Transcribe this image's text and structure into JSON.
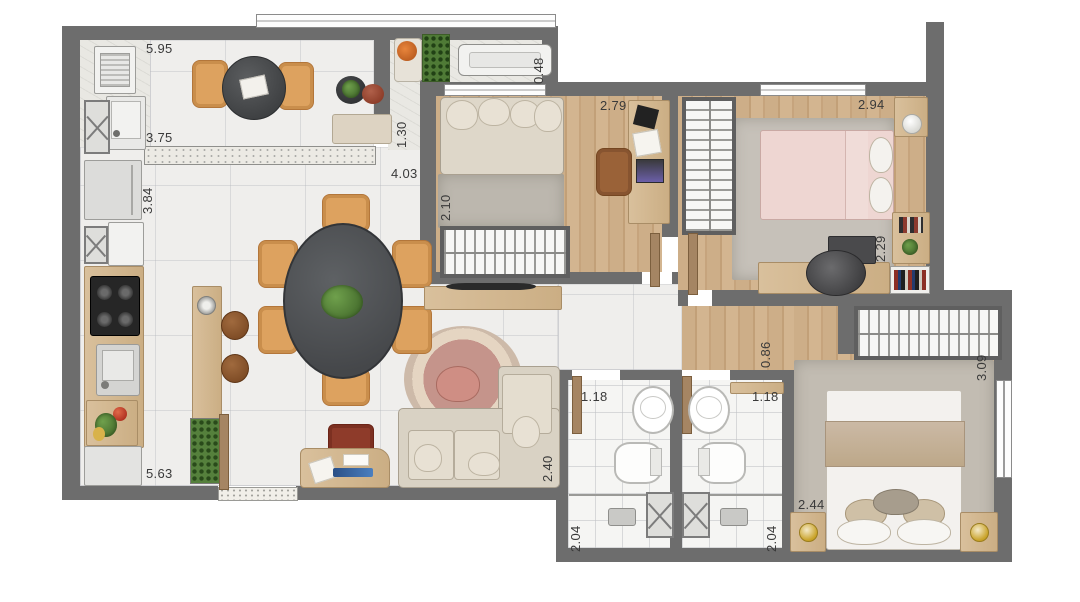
{
  "plan": {
    "type": "apartment-floor-plan",
    "colors": {
      "wall": "#6d6d6d",
      "marble_floor": "#efeeec",
      "wood_floor": "#cdae88",
      "bath_tile": "#f5f5f3",
      "dining_table": "#4c4e50",
      "chair_tan": "#dda25f",
      "sofa": "#d9d2c4",
      "bed_pink": "#eed6d2",
      "plant": "#55803c"
    },
    "dimension_labels": [
      {
        "id": "service-area-width",
        "text": "5.95",
        "orientation": "horizontal"
      },
      {
        "id": "kitchen-width",
        "text": "3.75",
        "orientation": "horizontal"
      },
      {
        "id": "kitchen-depth",
        "text": "3.84",
        "orientation": "vertical"
      },
      {
        "id": "balcony-niche-depth",
        "text": "1.30",
        "orientation": "vertical"
      },
      {
        "id": "living-width",
        "text": "4.03",
        "orientation": "horizontal"
      },
      {
        "id": "ac-ledge-depth",
        "text": "0.48",
        "orientation": "vertical"
      },
      {
        "id": "bedroom1-width",
        "text": "2.79",
        "orientation": "horizontal"
      },
      {
        "id": "bedroom1-depth",
        "text": "2.10",
        "orientation": "vertical"
      },
      {
        "id": "bedroom2-width",
        "text": "2.94",
        "orientation": "horizontal"
      },
      {
        "id": "bedroom2-depth",
        "text": "2.29",
        "orientation": "vertical"
      },
      {
        "id": "hallway-width",
        "text": "0.86",
        "orientation": "vertical"
      },
      {
        "id": "master-wardrobe-width",
        "text": "3.09",
        "orientation": "vertical"
      },
      {
        "id": "bathroom1-width",
        "text": "1.18",
        "orientation": "horizontal"
      },
      {
        "id": "bathroom2-width",
        "text": "1.18",
        "orientation": "horizontal"
      },
      {
        "id": "living-depth",
        "text": "2.40",
        "orientation": "vertical"
      },
      {
        "id": "master-bed-width",
        "text": "2.44",
        "orientation": "horizontal"
      },
      {
        "id": "bathroom1-depth",
        "text": "2.04",
        "orientation": "vertical"
      },
      {
        "id": "bathroom2-depth",
        "text": "2.04",
        "orientation": "vertical"
      },
      {
        "id": "living-length",
        "text": "5.63",
        "orientation": "horizontal"
      }
    ]
  }
}
